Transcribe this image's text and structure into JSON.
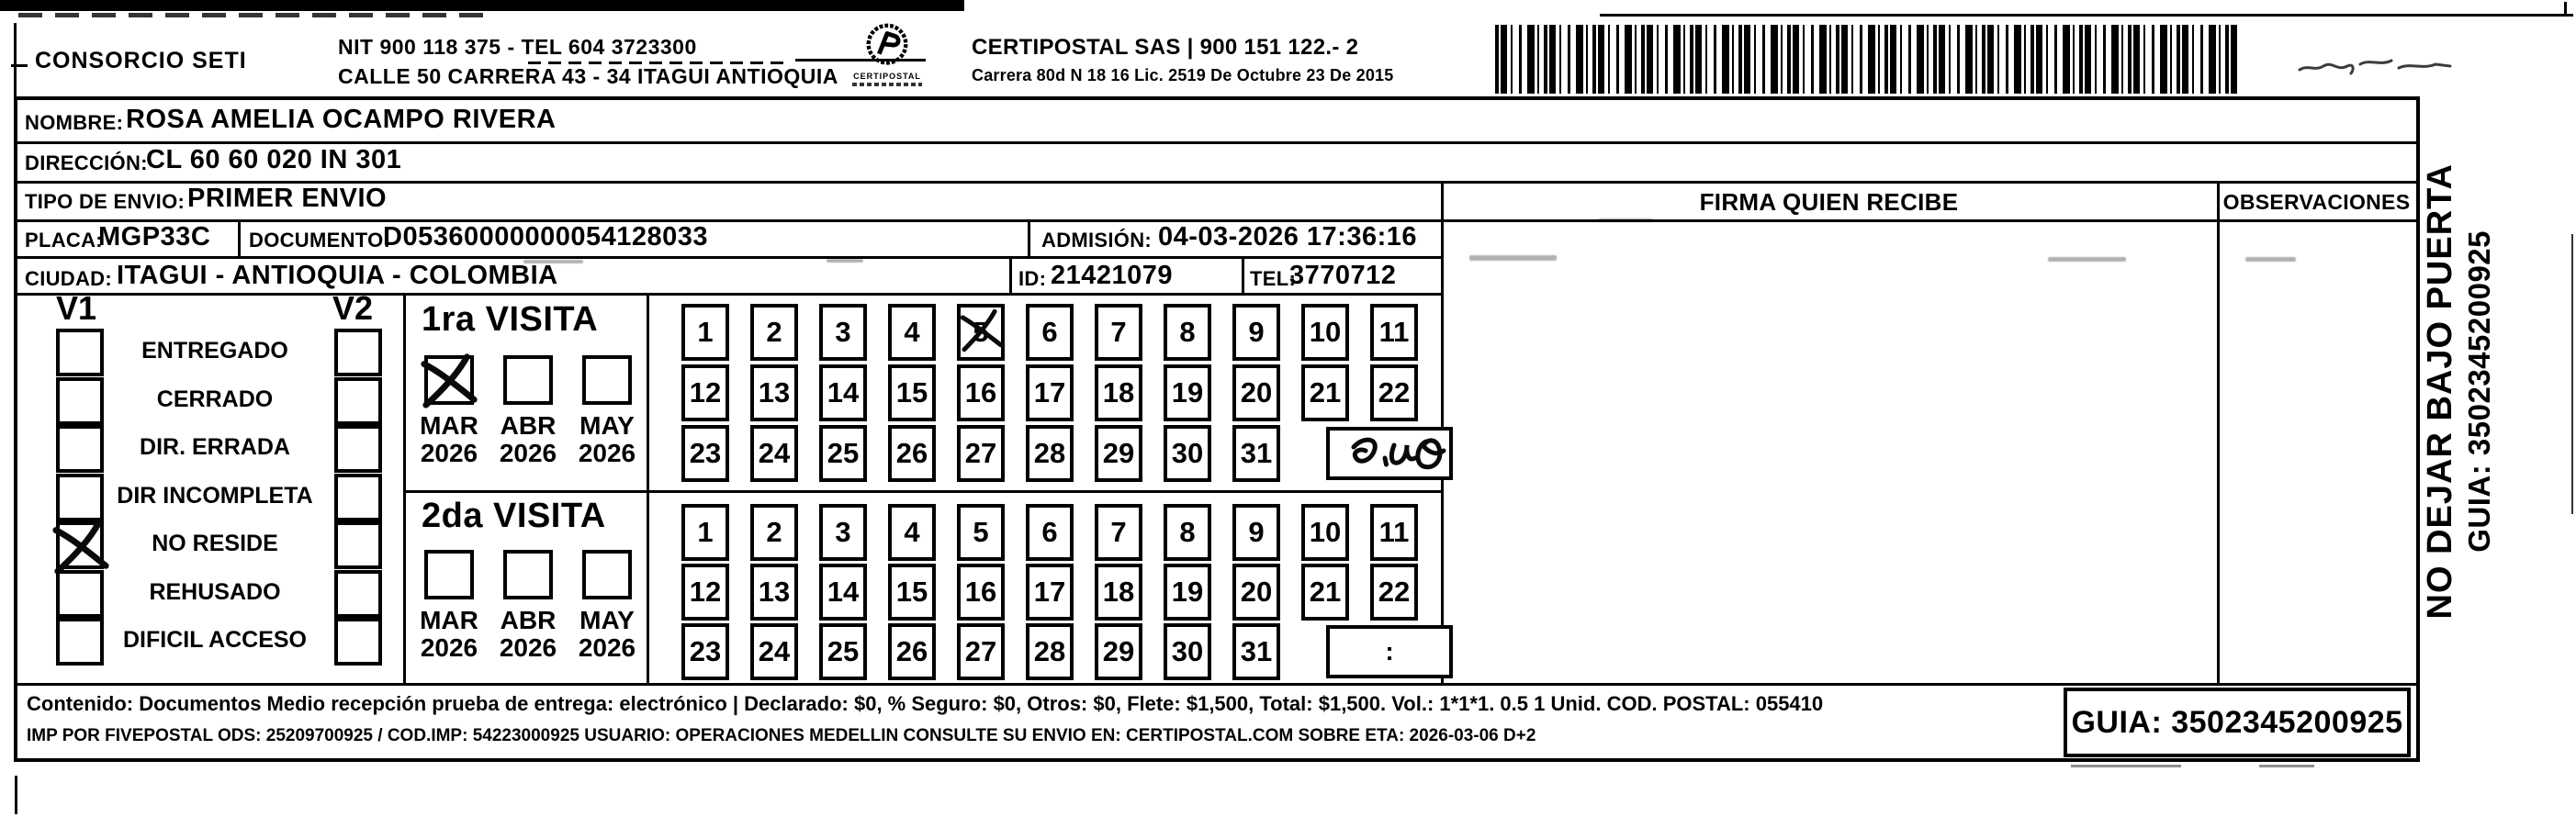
{
  "header": {
    "company": "CONSORCIO SETI",
    "nit_line": "NIT 900 118 375 - TEL 604 3723300",
    "address_line": "CALLE 50 CARRERA 43 - 34 ITAGUI ANTIOQUIA",
    "logo_text": "CERTIPOSTAL",
    "certipostal_line": "CERTIPOSTAL SAS | 900 151 122.- 2",
    "license_line": "Carrera 80d N 18 16  Lic. 2519 De Octubre 23 De 2015"
  },
  "recipient": {
    "nombre_label": "NOMBRE:",
    "nombre": "ROSA AMELIA OCAMPO RIVERA",
    "direccion_label": "DIRECCIÓN:",
    "direccion": "CL 60 60 020 IN 301",
    "tipo_envio_label": "TIPO DE ENVIO:",
    "tipo_envio": "PRIMER ENVIO",
    "placa_label": "PLACA:",
    "placa": "MGP33C",
    "documento_label": "DOCUMENTO:",
    "documento": "D05360000000054128033",
    "admision_label": "ADMISIÓN:",
    "admision": "04-03-2026 17:36:16",
    "ciudad_label": "CIUDAD:",
    "ciudad": "ITAGUI - ANTIOQUIA - COLOMBIA",
    "id_label": "ID:",
    "id": "21421079",
    "tel_label": "TEL:",
    "tel": "3770712"
  },
  "columns": {
    "firma": "FIRMA QUIEN RECIBE",
    "observaciones": "OBSERVACIONES"
  },
  "visits": {
    "v1_label": "V1",
    "v2_label": "V2",
    "statuses": [
      "ENTREGADO",
      "CERRADO",
      "DIR. ERRADA",
      "DIR INCOMPLETA",
      "NO RESIDE",
      "REHUSADO",
      "DIFICIL ACCESO"
    ],
    "v1_checked": "NO RESIDE",
    "first_visit": {
      "title": "1ra VISITA",
      "months": [
        "MAR",
        "ABR",
        "MAY"
      ],
      "years": [
        "2026",
        "2026",
        "2026"
      ],
      "checked_month": "MAR",
      "crossed_day": 5,
      "rows": [
        [
          1,
          2,
          3,
          4,
          5,
          6,
          7,
          8,
          9,
          10,
          11
        ],
        [
          12,
          13,
          14,
          15,
          16,
          17,
          18,
          19,
          20,
          21,
          22
        ],
        [
          23,
          24,
          25,
          26,
          27,
          28,
          29,
          30,
          31
        ]
      ]
    },
    "second_visit": {
      "title": "2da VISITA",
      "months": [
        "MAR",
        "ABR",
        "MAY"
      ],
      "years": [
        "2026",
        "2026",
        "2026"
      ],
      "checked_month": "",
      "note": ":",
      "rows": [
        [
          1,
          2,
          3,
          4,
          5,
          6,
          7,
          8,
          9,
          10,
          11
        ],
        [
          12,
          13,
          14,
          15,
          16,
          17,
          18,
          19,
          20,
          21,
          22
        ],
        [
          23,
          24,
          25,
          26,
          27,
          28,
          29,
          30,
          31
        ]
      ]
    }
  },
  "footer": {
    "line1": "Contenido: Documentos Medio recepción prueba de entrega: electrónico | Declarado: $0, % Seguro: $0, Otros: $0, Flete: $1,500, Total: $1,500. Vol.: 1*1*1. 0.5  1 Unid. COD. POSTAL: 055410",
    "line2": "IMP POR FIVEPOSTAL ODS: 25209700925 / COD.IMP: 54223000925 USUARIO: OPERACIONES MEDELLIN CONSULTE SU ENVIO EN: CERTIPOSTAL.COM SOBRE ETA: 2026-03-06 D+2",
    "guia": "GUIA: 3502345200925"
  },
  "side": {
    "no_dejar": "NO DEJAR BAJO PUERTA",
    "guia": "GUIA: 3502345200925"
  }
}
